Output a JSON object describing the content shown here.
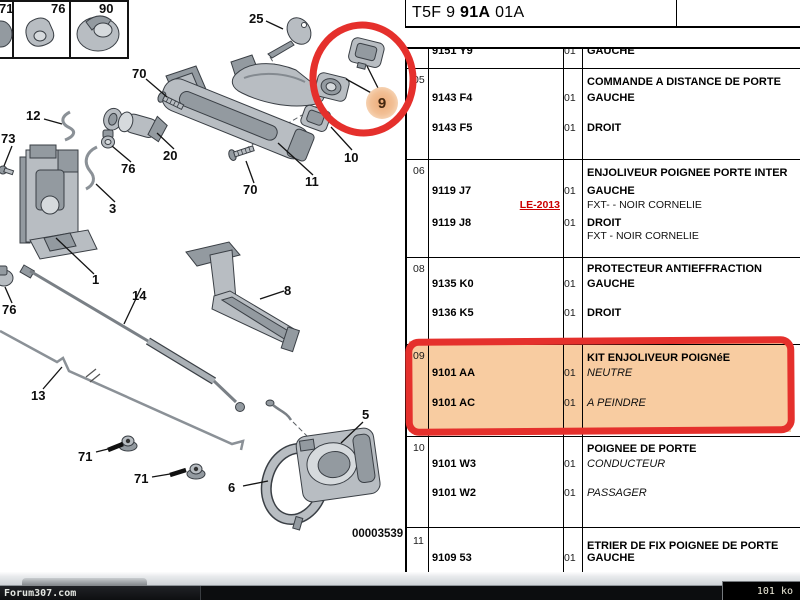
{
  "header": {
    "code_prefix": "T5F 9",
    "code_bold": "91A",
    "code_suffix": "01A"
  },
  "table": {
    "sections": [
      {
        "ref": "",
        "title": "",
        "rows": [
          {
            "part": "9151 Y9",
            "qty": "01",
            "desc": "GAUCHE"
          }
        ]
      },
      {
        "ref": "05",
        "title": "COMMANDE A DISTANCE DE PORTE",
        "rows": [
          {
            "part": "9143 F4",
            "qty": "01",
            "desc": "GAUCHE"
          },
          {
            "part": "9143 F5",
            "qty": "01",
            "desc": "DROIT"
          }
        ]
      },
      {
        "ref": "06",
        "title": "ENJOLIVEUR POIGNEE PORTE INTER",
        "rows": [
          {
            "part": "9119 J7",
            "qty": "01",
            "desc": "GAUCHE"
          },
          {
            "link": "LE-2013",
            "desc": "FXT- - NOIR CORNELIE"
          },
          {
            "part": "9119 J8",
            "qty": "01",
            "desc": "DROIT"
          },
          {
            "desc": "FXT - NOIR CORNELIE"
          }
        ]
      },
      {
        "ref": "08",
        "title": "PROTECTEUR ANTIEFFRACTION",
        "rows": [
          {
            "part": "9135 K0",
            "qty": "01",
            "desc": "GAUCHE"
          },
          {
            "part": "9136 K5",
            "qty": "01",
            "desc": "DROIT"
          }
        ]
      },
      {
        "ref": "09",
        "title": "KIT ENJOLIVEUR POIGNéE",
        "highlighted": true,
        "rows": [
          {
            "part": "9101 AA",
            "qty": "01",
            "desc": "NEUTRE",
            "italic": true
          },
          {
            "part": "9101 AC",
            "qty": "01",
            "desc": "A PEINDRE",
            "italic": true
          }
        ]
      },
      {
        "ref": "10",
        "title": "POIGNEE DE PORTE",
        "rows": [
          {
            "part": "9101 W3",
            "qty": "01",
            "desc": "CONDUCTEUR",
            "italic": true
          },
          {
            "part": "9101 W2",
            "qty": "01",
            "desc": "PASSAGER",
            "italic": true
          }
        ]
      },
      {
        "ref": "11",
        "title": "ETRIER DE FIX POIGNEE DE PORTE",
        "rows": [
          {
            "part": "9109 53",
            "qty": "01",
            "desc": "GAUCHE"
          }
        ]
      }
    ]
  },
  "diagram": {
    "labels": [
      "71",
      "76",
      "90",
      "25",
      "70",
      "9",
      "12",
      "73",
      "20",
      "76",
      "10",
      "11",
      "3",
      "70",
      "1",
      "14",
      "8",
      "76",
      "13",
      "71",
      "71",
      "5",
      "6"
    ],
    "drawing_number": "00003539"
  },
  "annotations": {
    "marker_color": "#e5302c",
    "highlight_fill": "#f8cca1",
    "circled_part": "9",
    "highlighted_section": "09"
  },
  "statusbar": {
    "watermark": "Forum307.com",
    "file_size": "101 ko"
  }
}
